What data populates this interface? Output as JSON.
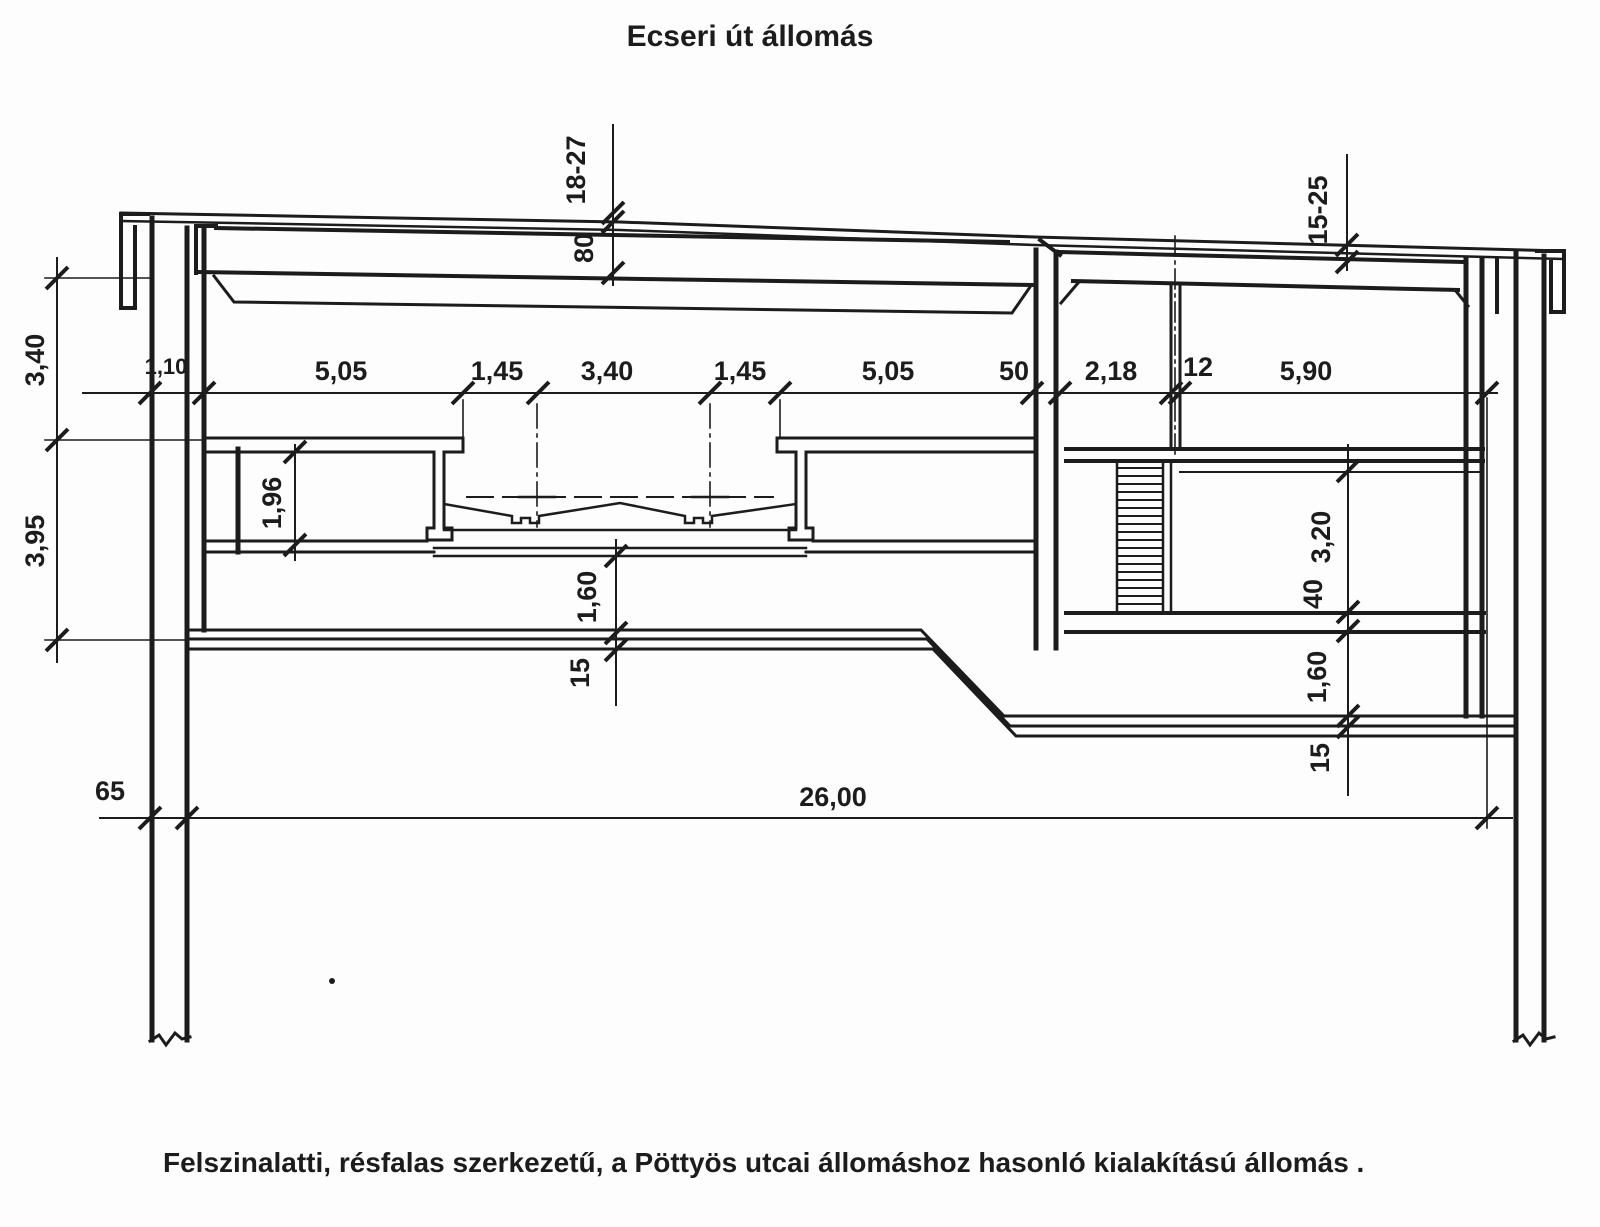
{
  "title": "Ecseri út állomás",
  "caption": "Felszinalatti, résfalas szerkezetű, a Pöttyös utcai állomáshoz hasonló kialakítású állomás .",
  "colors": {
    "ink": "#1c1c1c",
    "paper": "#fdfdfd"
  },
  "dimensions": {
    "top_cover": "18-27",
    "roof_slab": "80",
    "right_cover": "15-25",
    "left_upper_height": "3,40",
    "left_lower_height": "3,95",
    "wall_lining": "1,10",
    "platform_left": "5,05",
    "track_gap_left": "1,45",
    "track_center": "3,40",
    "track_gap_right": "1,45",
    "platform_right": "5,05",
    "mid_wall": "50",
    "stair_bay": "2,18",
    "partition": "12",
    "right_hall": "5,90",
    "under_platform_height": "1,96",
    "center_base_gap": "1,60",
    "center_base_slab": "15",
    "right_room_height": "3,20",
    "right_floor_slab": "40",
    "right_base_gap": "1,60",
    "right_base_slab": "15",
    "diaphragm_wall_width": "65",
    "total_width": "26,00"
  }
}
